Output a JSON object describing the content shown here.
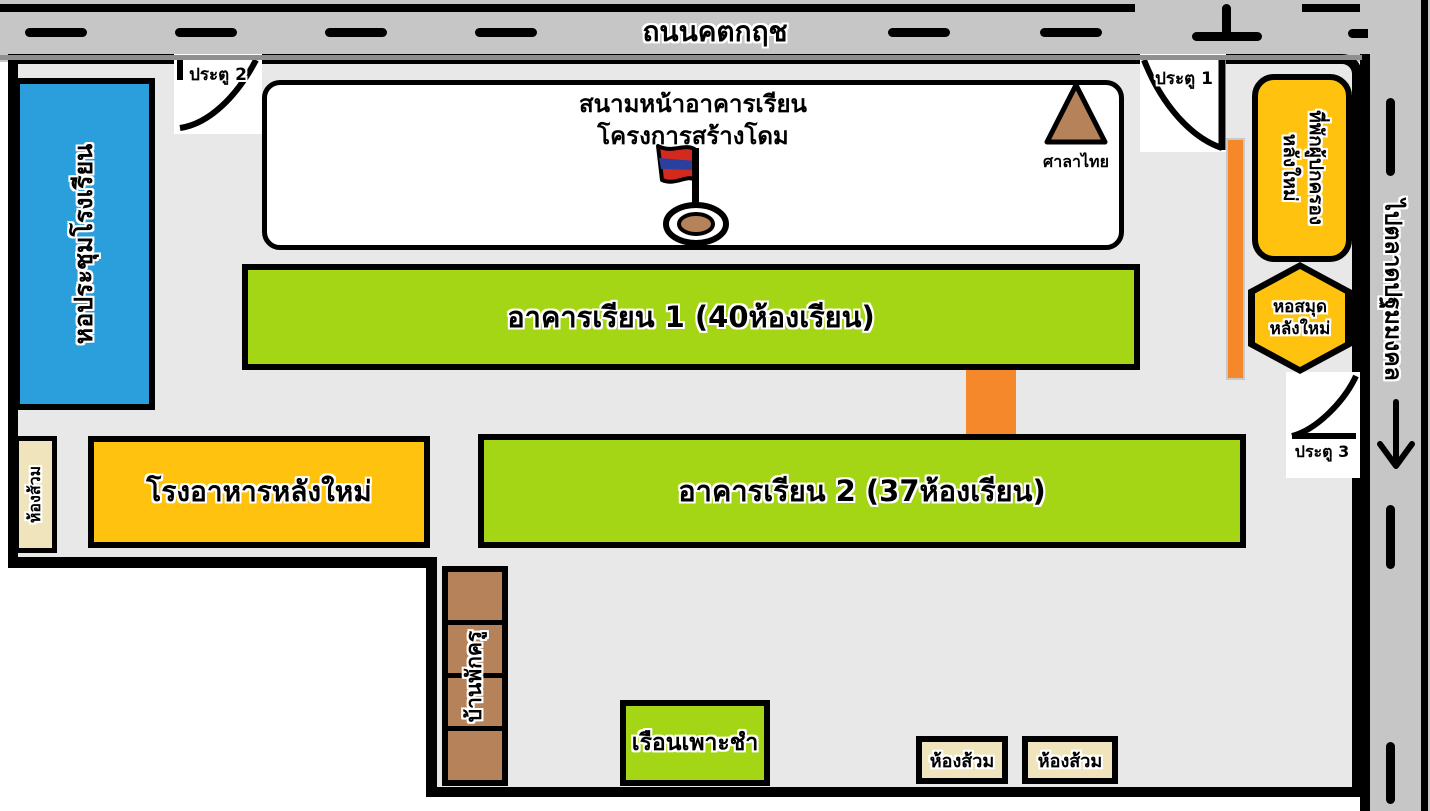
{
  "roads": {
    "top": {
      "label": "ถนนคตกฤช"
    },
    "right": {
      "label": "ไปตลาดปฐมมงคล",
      "arrow_icon": "down-arrow"
    }
  },
  "gates": {
    "gate1": {
      "label": "ประตู 1"
    },
    "gate2": {
      "label": "ประตู 2"
    },
    "gate3": {
      "label": "ประตู 3"
    }
  },
  "areas": {
    "field": {
      "line1": "สนามหน้าอาคารเรียน",
      "line2": "โครงการสร้างโดม"
    },
    "pavilion": {
      "label": "ศาลาไทย"
    },
    "auditorium": {
      "label": "หอประชุมโรงเรียน"
    },
    "building1": {
      "label": "อาคารเรียน 1 (40ห้องเรียน)"
    },
    "building2": {
      "label": "อาคารเรียน 2 (37ห้องเรียน)"
    },
    "cafeteria": {
      "label": "โรงอาหารหลังใหม่"
    },
    "toilet_left": {
      "label": "ห้องส้วม"
    },
    "parents_residence": {
      "line1": "ที่พักผู้ปกครอง",
      "line2": "หลังใหม่"
    },
    "library": {
      "line1": "หอสมุด",
      "line2": "หลังใหม่"
    },
    "teacher_house": {
      "label": "บ้านพักครู"
    },
    "nursery": {
      "label": "เรือนเพาะชำ"
    },
    "toilet_bottom_left": {
      "label": "ห้องส้วม"
    },
    "toilet_bottom_right": {
      "label": "ห้องส้วม"
    }
  },
  "icons": {
    "flag": "thai-flag-marker",
    "pavilion": "triangle-pavilion",
    "road_arrow": "down-arrow",
    "gate_arcs": "quarter-circle-gate-swing"
  },
  "colors": {
    "road_gray": "#c6c6c6",
    "campus_gray": "#e8e8e8",
    "auditorium_blue": "#2b9edc",
    "building_green": "#a5d616",
    "facility_yellow": "#ffc20e",
    "walkway_orange": "#f6882c",
    "wood_brown": "#b5825a",
    "toilet_cream": "#efe4bc"
  }
}
